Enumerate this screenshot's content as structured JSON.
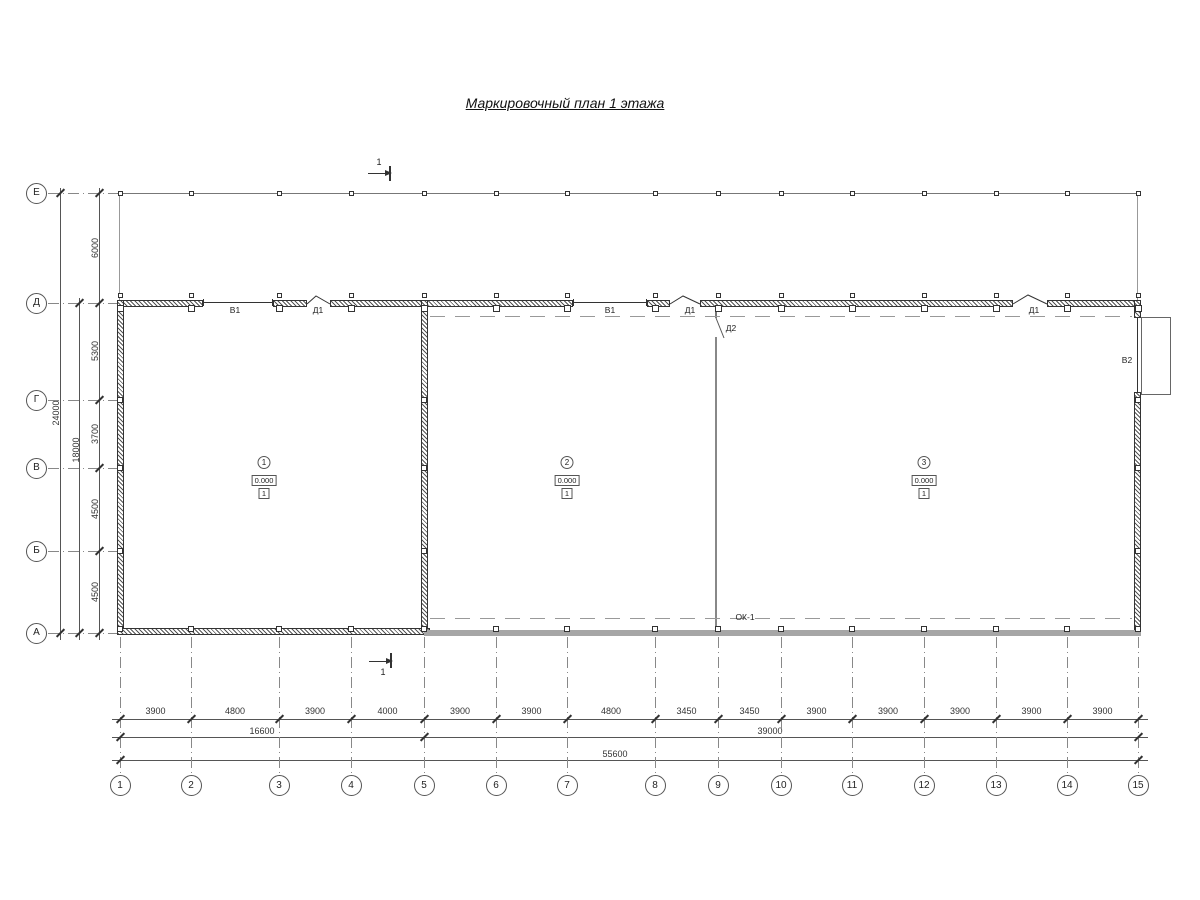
{
  "title": "Маркировочный план 1 этажа",
  "grid": {
    "rows": [
      "Е",
      "Д",
      "Г",
      "В",
      "Б",
      "А"
    ],
    "columns": [
      "1",
      "2",
      "3",
      "4",
      "5",
      "6",
      "7",
      "8",
      "9",
      "10",
      "11",
      "12",
      "13",
      "14",
      "15"
    ]
  },
  "dimensions": {
    "bottom_segments": [
      "3900",
      "4800",
      "3900",
      "4000",
      "3900",
      "3900",
      "4800",
      "3450",
      "3450",
      "3900",
      "3900",
      "3900",
      "3900",
      "3900"
    ],
    "bottom_subtotal_left": "16600",
    "bottom_subtotal_right": "39000",
    "bottom_total": "55600",
    "left_segments": [
      "6000",
      "5300",
      "3700",
      "4500",
      "4500"
    ],
    "left_subtotal": "18000",
    "left_total": "24000"
  },
  "openings": {
    "window_type1": "В1",
    "door_type1": "Д1",
    "door_type2": "Д2",
    "window_type2": "В2",
    "bottom_mark": "ОК-1"
  },
  "rooms": [
    {
      "number": "1",
      "elevation": "0.000",
      "floor_type": "1"
    },
    {
      "number": "2",
      "elevation": "0.000",
      "floor_type": "1"
    },
    {
      "number": "3",
      "elevation": "0.000",
      "floor_type": "1"
    }
  ],
  "section_mark": "1"
}
